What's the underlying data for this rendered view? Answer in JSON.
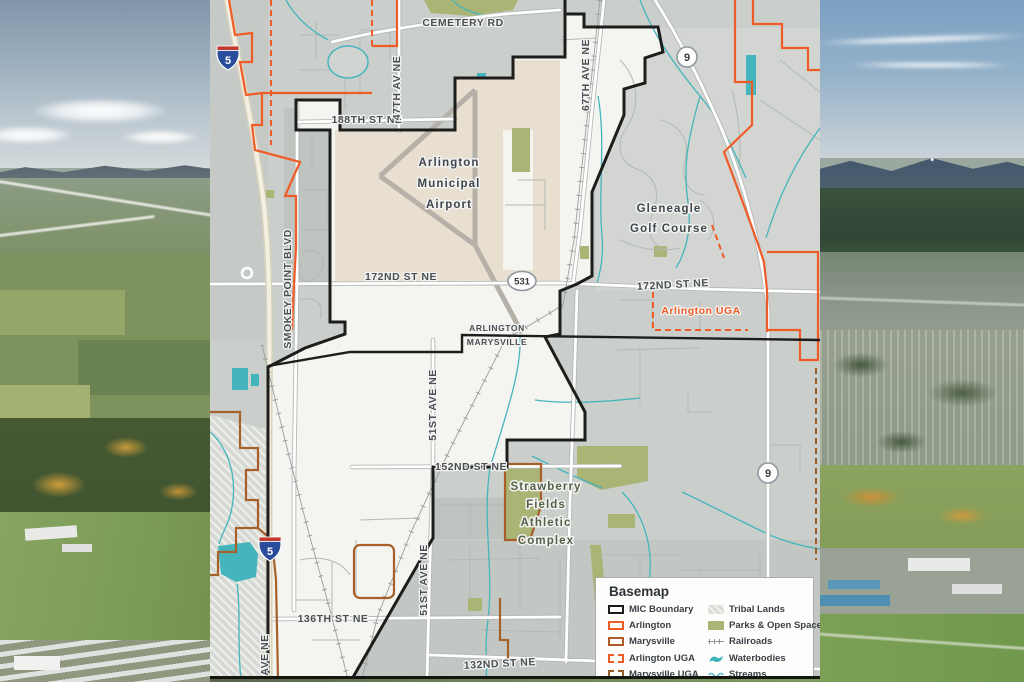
{
  "map": {
    "road_labels": {
      "cemetery_rd": "CEMETERY RD",
      "st_188th": "188TH ST NE",
      "av_47th": "47TH AV NE",
      "ave_67th": "67TH AVE NE",
      "st_172nd_west": "172ND ST NE",
      "st_172nd_east": "172ND ST NE",
      "smokey_point_blvd": "SMOKEY POINT BLVD",
      "ave_51st_north": "51ST AVE NE",
      "ave_51st_south": "51ST AVE NE",
      "st_152nd": "152ND ST NE",
      "st_136th": "136TH ST NE",
      "st_132nd": "132ND ST NE",
      "ave_ne_partial": "AVE NE"
    },
    "place_labels": {
      "airport_line1": "Arlington",
      "airport_line2": "Municipal",
      "airport_line3": "Airport",
      "gleneagle_line1": "Gleneagle",
      "gleneagle_line2": "Golf Course",
      "arlington_uga": "Arlington UGA",
      "strawberry_line1": "Strawberry",
      "strawberry_line2": "Fields",
      "strawberry_line3": "Athletic",
      "strawberry_line4": "Complex",
      "city_arlington": "ARLINGTON",
      "city_marysville": "MARYSVILLE",
      "tulalip_partial": "Tulalip"
    },
    "shields": {
      "i5_top": "5",
      "i5_bottom": "5",
      "sr9_top": "9",
      "sr9_bottom": "9",
      "sr531": "531"
    }
  },
  "legend": {
    "title": "Basemap",
    "items": [
      {
        "label": "MIC Boundary",
        "swatch": "mic-boundary"
      },
      {
        "label": "Arlington",
        "swatch": "arlington"
      },
      {
        "label": "Marysville",
        "swatch": "marysville"
      },
      {
        "label": "Arlington UGA",
        "swatch": "arlington-uga"
      },
      {
        "label": "Marysville UGA",
        "swatch": "marysville-uga"
      },
      {
        "label": "Tribal Lands",
        "swatch": "tribal-lands"
      },
      {
        "label": "Parks & Open Space",
        "swatch": "parks-open-space"
      },
      {
        "label": "Railroads",
        "swatch": "railroads"
      },
      {
        "label": "Waterbodies",
        "swatch": "waterbodies"
      },
      {
        "label": "Streams",
        "swatch": "streams"
      }
    ]
  },
  "colors": {
    "mic_boundary": "#1d1d1b",
    "arlington": "#ef5c28",
    "marysville": "#b05a28",
    "marysville_uga": "#9a5f28",
    "parks": "#a9b475",
    "water": "#45b5bd",
    "airport_fill": "#e9dfd0",
    "map_bg": "#cbcfcc",
    "mic_fill": "#f4f4f1"
  }
}
